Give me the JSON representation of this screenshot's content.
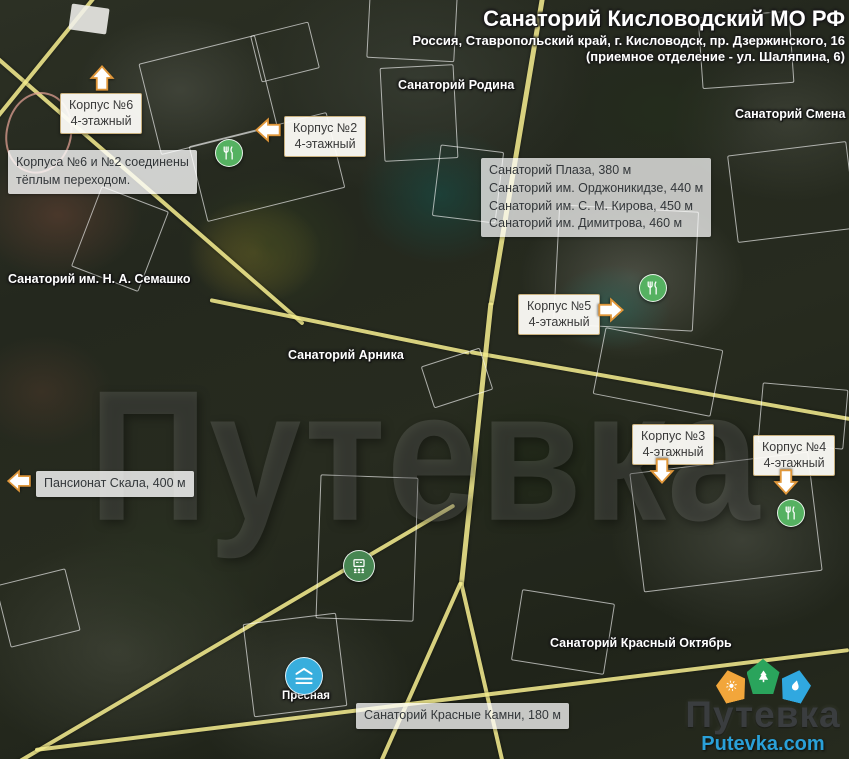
{
  "title": {
    "line1": "Санаторий Кисловодский МО РФ",
    "line2": "Россия, Ставропольский край, г. Кисловодск, пр. Дзержинского, 16",
    "line3": "(приемное отделение - ул. Шаляпина, 6)"
  },
  "callouts": {
    "korpus6": {
      "line1": "Корпус №6",
      "line2": "4-этажный"
    },
    "korpus2": {
      "line1": "Корпус №2",
      "line2": "4-этажный"
    },
    "korpus5": {
      "line1": "Корпус №5",
      "line2": "4-этажный"
    },
    "korpus3": {
      "line1": "Корпус №3",
      "line2": "4-этажный"
    },
    "korpus4": {
      "line1": "Корпус №4",
      "line2": "4-этажный"
    }
  },
  "info_boxes": {
    "connection": {
      "line1": "Корпуса №6 и №2 соединены",
      "line2": "тёплым переходом."
    },
    "nearby": {
      "line1": "Санаторий Плаза, 380 м",
      "line2": "Санаторий им. Орджоникидзе, 440 м",
      "line3": "Санаторий им. С. М. Кирова, 450 м",
      "line4": "Санаторий им. Димитрова, 460 м"
    },
    "skala": {
      "text": "Пансионат Скала, 400 м"
    },
    "krasnye_kamni": {
      "text": "Санаторий Красные Камни, 180 м"
    }
  },
  "map_labels": {
    "rodina": "Санаторий Родина",
    "smena": "Санаторий Смена",
    "semashko": "Санаторий им. Н. А. Семашко",
    "arnika": "Санаторий Арника",
    "krasny_oktyabr": "Санаторий Красный Октябрь",
    "presnaya": "Пресная"
  },
  "watermark": "Путевка",
  "logo": {
    "name": "Путевка",
    "site": "Putevka.com"
  },
  "icons": {
    "restaurant": "restaurant-icon",
    "conference": "conference-icon",
    "pool": "pool-icon",
    "sun_badge": "sun-badge-icon",
    "tree_badge": "tree-badge-icon",
    "drop_badge": "water-drop-badge-icon",
    "callout_arrow": "callout-arrow-icon"
  },
  "colors": {
    "road": "#f0e88c",
    "callout_border": "#c8b07e",
    "arrow_stroke": "#e0973a",
    "restaurant_green": "#55b161",
    "conference_green": "#478652",
    "pool_blue": "#38aedd",
    "badge_orange": "#f2a63b",
    "badge_green": "#2aa45c",
    "badge_blue": "#30a8e0",
    "logo_text": "#3a3d3f",
    "logo_site": "#2aa0d8",
    "highlight_yellow": "#c39a32",
    "highlight_teal": "#1f5e57"
  }
}
